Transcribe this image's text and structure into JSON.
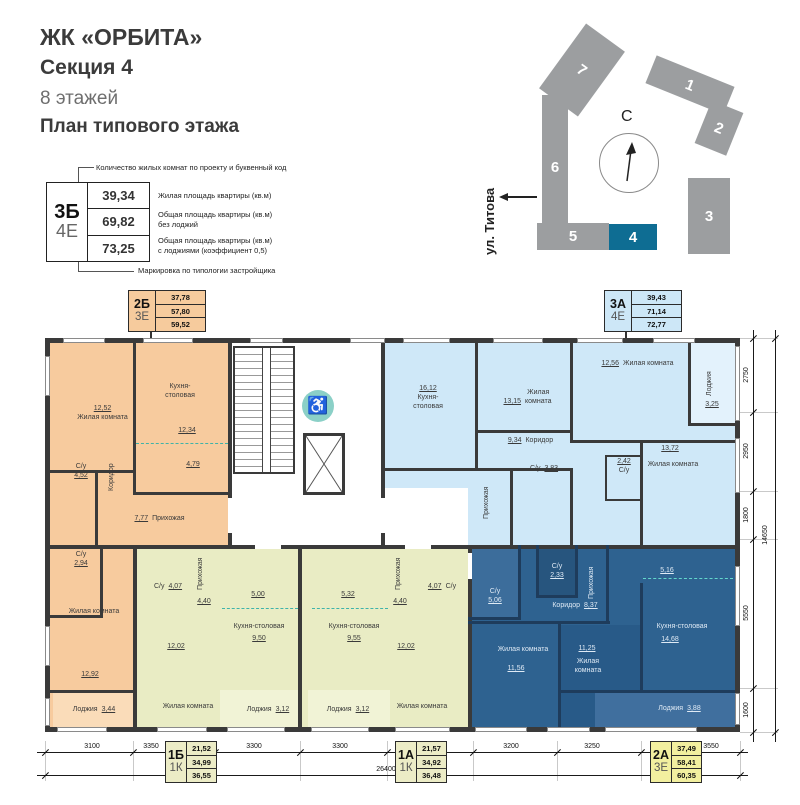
{
  "header": {
    "project": "ЖК «ОРБИТА»",
    "section": "Секция 4",
    "floors": "8 этажей",
    "plan_title": "План типового этажа"
  },
  "legend": {
    "top_note": "Количество жилых комнат по проекту и буквенный код",
    "bottom_note": "Маркировка по типологии застройщика",
    "code_rooms": "3Б",
    "code_type": "4Е",
    "row1_value": "39,34",
    "row1_label": "Жилая площадь квартиры (кв.м)",
    "row2_value": "69,82",
    "row2_label": "Общая площадь квартиры (кв.м)\nбез лоджий",
    "row3_value": "73,25",
    "row3_label": "Общая площадь квартиры (кв.м)\nс лоджиями (коэффициент 0,5)"
  },
  "site_plan": {
    "north": "С",
    "street": "ул. Титова",
    "b1": "1",
    "b2": "2",
    "b3": "3",
    "b4": "4",
    "b5": "5",
    "b6": "6",
    "b7": "7",
    "highlighted_building": "4"
  },
  "tags": [
    {
      "code1": "2Б",
      "code2": "3Е",
      "v1": "37,78",
      "v2": "57,80",
      "v3": "59,52"
    },
    {
      "code1": "3А",
      "code2": "4Е",
      "v1": "39,43",
      "v2": "71,14",
      "v3": "72,77"
    },
    {
      "code1": "1Б",
      "code2": "1К",
      "v1": "21,52",
      "v2": "34,99",
      "v3": "36,55"
    },
    {
      "code1": "1А",
      "code2": "1К",
      "v1": "21,57",
      "v2": "34,92",
      "v3": "36,48"
    },
    {
      "code1": "2А",
      "code2": "3Е",
      "v1": "37,49",
      "v2": "58,41",
      "v3": "60,35"
    }
  ],
  "apt2b": {
    "room1_area": "12,52",
    "room1": "Жилая комната",
    "kitchen": "Кухня-\nстоловая",
    "kitchen_area": "12,34",
    "kitchen_zone": "4,79",
    "corridor": "Коридор",
    "bath1": "С/у",
    "bath1_area": "4,52",
    "hall": "Прихожая",
    "hall_area": "7,77",
    "bath2": "С/у",
    "bath2_area": "2,94",
    "room2": "Жилая комната",
    "room2_area": "12,92",
    "loggia": "Лоджия",
    "loggia_area": "3,44"
  },
  "apt3a": {
    "kitchen_area": "16,12",
    "kitchen": "Кухня-\nстоловая",
    "room1_area": "13,15",
    "room1": "Жилая\nкомната",
    "room2_area": "12,56",
    "room2": "Жилая комната",
    "loggia": "Лоджия",
    "loggia_area": "3,25",
    "corridor_area": "9,34",
    "corridor": "Коридор",
    "hall": "Прихожая",
    "bath1": "С/у",
    "bath1_area": "3,83",
    "bath2_area": "2,42",
    "bath2": "С/у",
    "room3_area": "13,72",
    "room3": "Жилая комната"
  },
  "apt1b": {
    "bath": "С/у",
    "bath_area": "4,07",
    "hall": "Прихожая",
    "hall_area": "4,40",
    "kitchen_zone": "5,00",
    "kitchen": "Кухня-столовая",
    "kitchen_area": "9,50",
    "room_area": "12,02",
    "room": "Жилая комната",
    "loggia": "Лоджия",
    "loggia_area": "3,12"
  },
  "apt1a": {
    "kitchen_zone": "5,32",
    "kitchen": "Кухня-столовая",
    "kitchen_area": "9,55",
    "hall": "Прихожая",
    "hall_area": "4,40",
    "bath_area": "4,07",
    "bath": "С/у",
    "room_area": "12,02",
    "room": "Жилая комната",
    "loggia": "Лоджия",
    "loggia_area": "3,12"
  },
  "apt2a": {
    "bath1": "С/у",
    "bath1_area": "5,06",
    "bath2": "С/у",
    "bath2_area": "2,33",
    "hall": "Прихожая",
    "corridor": "Коридор",
    "corridor_area": "8,37",
    "room1": "Жилая комната",
    "room1_area": "11,56",
    "room2_area": "11,25",
    "room2": "Жилая\nкомната",
    "kitchen_zone": "5,16",
    "kitchen": "Кухня-столовая",
    "kitchen_area": "14,68",
    "loggia": "Лоджия",
    "loggia_area": "3,88"
  },
  "dims": {
    "bottom": [
      "3100",
      "3350",
      "3300",
      "3300",
      "3200",
      "3250",
      "3550"
    ],
    "bottom_total": "26400",
    "right": [
      "2750",
      "2950",
      "1800",
      "5550",
      "1600"
    ],
    "right_total": "14650"
  },
  "colors": {
    "highlight_building": "#0e6d93",
    "apt_2b": "#f7cb9e",
    "apt_3a": "#cfe8f8",
    "apt_1b": "#e9ecc4",
    "apt_1a": "#e9ecc4",
    "apt_2a": "#2e6290",
    "walls": "#3a3a3a",
    "accessible_icon_circle": "#8bd0c7"
  }
}
